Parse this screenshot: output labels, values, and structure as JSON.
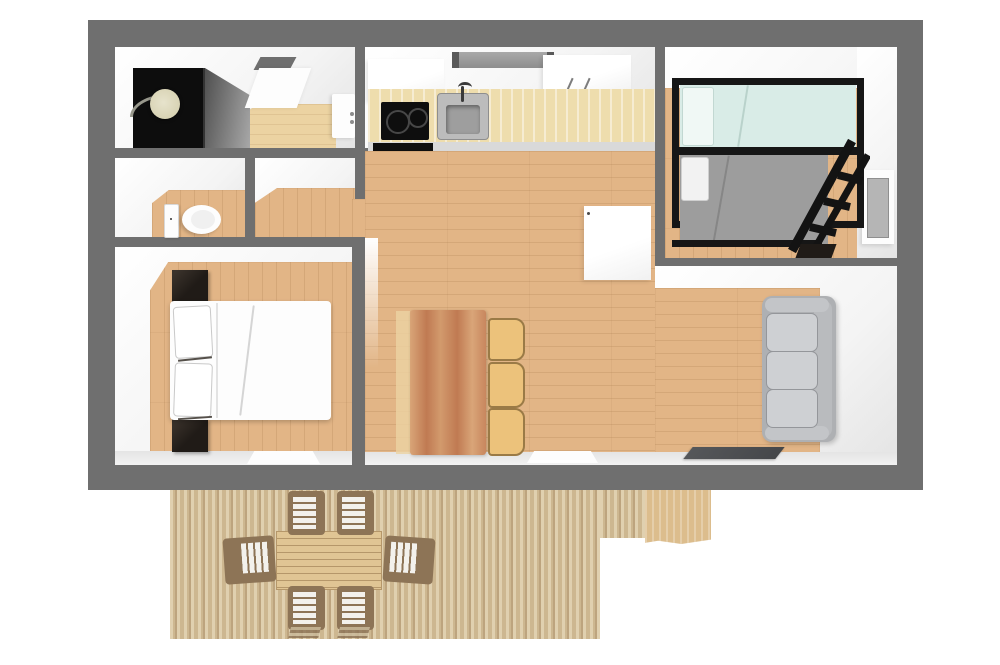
{
  "palette": {
    "page_bg": "#ffffff",
    "wall": "#6f6f6f",
    "wall_face": "#f4f4f4",
    "wall_face_bright": "#ffffff",
    "wall_face_shade": "#e4e4e4",
    "floor_wood": "#e2b586",
    "bath_wood": "#ecd3a2",
    "counter": "#eeddad",
    "counter_front": "#d9d9d9",
    "appliance_black": "#0e0e0e",
    "steel": "#bcbcbc",
    "steel_dark": "#9e9e9e",
    "hood_gray": "#8d8d8d",
    "table_wood_light": "#d9a578",
    "table_wood_dark": "#c07a52",
    "chair_wood": "#ecc27b",
    "chair_wood_edge": "#9a7a46",
    "sofa_base": "#aeb0b3",
    "sofa_cushion": "#ced0d3",
    "sofa_edge": "#94969a",
    "bunk_frame": "#161616",
    "bunk_top_bedding": "#d9ece7",
    "bunk_bottom_bedding": "#9d9d9d",
    "bed_white": "#fdfdfd",
    "dark_furniture": "#201b17",
    "door_panel": "#b5b5b5",
    "deck_a": "#e0d0af",
    "deck_b": "#cdb790",
    "deck_c": "#bda47e",
    "deck_solid": "#dcbd8d",
    "outdoor_table": "#e0c594",
    "outdoor_table_line": "#b5976a",
    "outdoor_chair_frame": "#8d7456",
    "outdoor_chair_slat": "#f3f1ec",
    "tv_dark": "#45474a",
    "shower_dark": "#0d0d0d",
    "glass_light": "#a8a8a8",
    "glass_dark": "#4f4f4f",
    "showerhead": "#d8d3b4"
  },
  "floorplan": {
    "view": "3d-top-down-floor-plan",
    "rooms": [
      {
        "id": "bathroom",
        "furniture": [
          "corner-shower",
          "shower-head",
          "skylight-window",
          "washbasin"
        ]
      },
      {
        "id": "wc",
        "furniture": [
          "toilet",
          "door"
        ]
      },
      {
        "id": "hallway",
        "furniture": []
      },
      {
        "id": "bedroom",
        "furniture": [
          "double-bed",
          "pillows",
          "nightstand-top",
          "nightstand-bottom",
          "window"
        ]
      },
      {
        "id": "kitchen",
        "furniture": [
          "upper-cabinet-left",
          "range-hood",
          "upper-cabinet-right",
          "counter",
          "cooktop",
          "sink",
          "oven-front"
        ]
      },
      {
        "id": "bunk-room",
        "furniture": [
          "bunk-bed",
          "ladder",
          "door",
          "storage-box"
        ]
      },
      {
        "id": "living-room",
        "furniture": [
          "wardrobe",
          "dining-table",
          "chair-1",
          "chair-2",
          "chair-3",
          "sofa",
          "wall-tv",
          "window"
        ]
      },
      {
        "id": "deck",
        "furniture": [
          "outdoor-table",
          "outdoor-chair-top-1",
          "outdoor-chair-top-2",
          "outdoor-chair-left",
          "outdoor-chair-right",
          "outdoor-chair-bottom-1",
          "outdoor-chair-bottom-2"
        ]
      }
    ]
  }
}
